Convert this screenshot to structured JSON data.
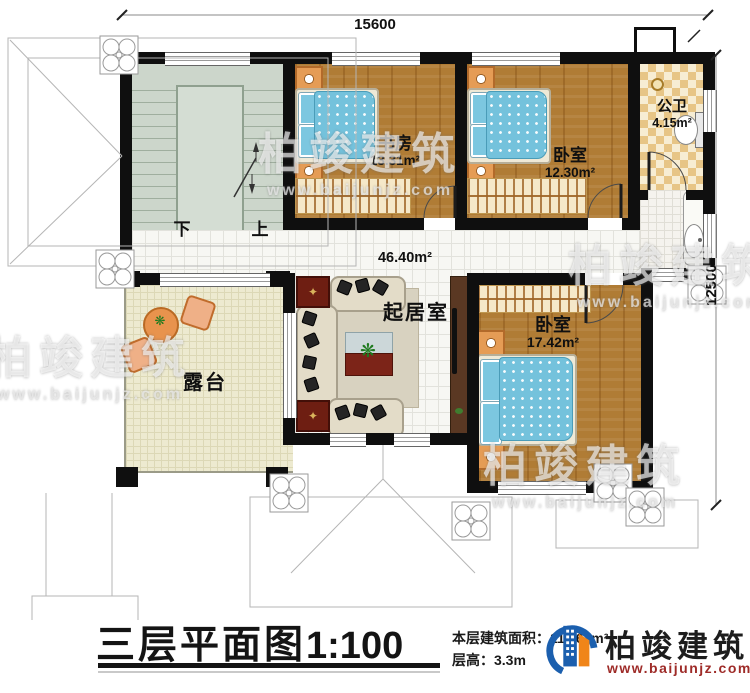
{
  "plan": {
    "dimensions": {
      "width_mm": "15600",
      "height_mm": "12500"
    },
    "rooms": [
      {
        "name": "书房",
        "area": "13.31m²"
      },
      {
        "name": "卧室",
        "area": "12.30m²"
      },
      {
        "name": "公卫",
        "area": "4.15m²"
      },
      {
        "name": "起居室",
        "area": "46.40m²"
      },
      {
        "name": "卧室",
        "area": "17.42m²"
      },
      {
        "name": "露台",
        "area": ""
      }
    ],
    "stairs": {
      "down_label": "下",
      "up_label": "上"
    },
    "icons": {
      "plant": "❋",
      "carpet_medallion": "✦"
    }
  },
  "title_block": {
    "title": "三层平面图",
    "scale": "1:100",
    "area_label": "本层建筑面积：",
    "area_value": "111.63m²",
    "height_label": "层高：",
    "height_value": "3.3m"
  },
  "brand": {
    "name": "柏竣建筑",
    "website": "www.baijunjz.com"
  },
  "watermark": {
    "text": "柏竣建筑",
    "subtext": "www.baijunjz.com"
  },
  "colors": {
    "wall": "#0f0f0f",
    "wood_floor": "#b07c35",
    "bed_blue": "#74c2dc",
    "stair_floor": "#ccd6cb",
    "terrace_floor": "#edead0",
    "brand_blue": "#1b5fae",
    "brand_orange": "#f08519",
    "brand_red": "#9e2b28"
  }
}
